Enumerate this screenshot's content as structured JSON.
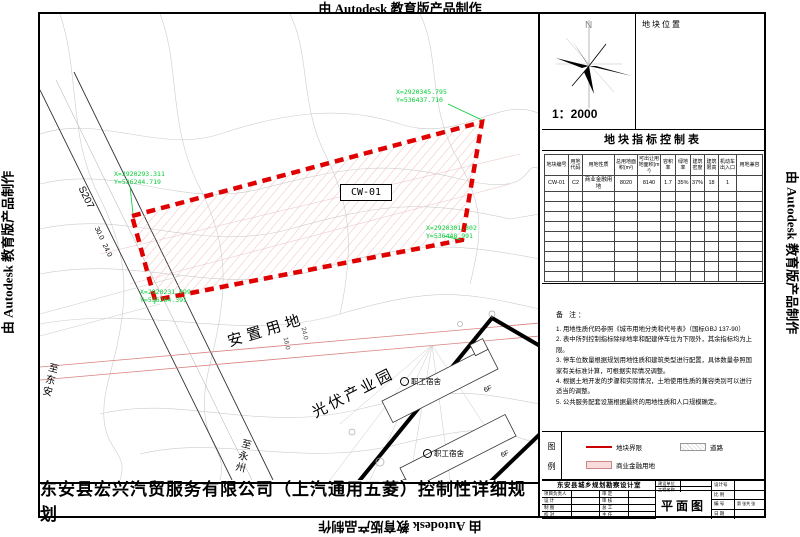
{
  "watermark": {
    "text": "由 Autodesk 教育版产品制作"
  },
  "colors": {
    "boundary_red": "#e00000",
    "coord_green": "#00cc33",
    "parcel_pink": "#f8dcdc"
  },
  "map": {
    "parcel_code": "CW-01",
    "coord_labels": [
      {
        "x": "X=2920345.795",
        "y": "Y=536437.710"
      },
      {
        "x": "X=2920293.311",
        "y": "Y=536244.719"
      },
      {
        "x": "X=2920301.302",
        "y": "Y=536448.991"
      },
      {
        "x": "X=2920231.099",
        "y": "Y=536264.391"
      }
    ],
    "road_label": "S207",
    "dim_30": "30.0",
    "dim_24": "24.0",
    "dim_16": "16.0",
    "dim_24b": "24.0",
    "to_dongan": "至东安",
    "to_yongzhou": "至永州",
    "resettlement_label": "安置用地",
    "pv_park_label": "光伏产业园",
    "dorm_label": "职工宿舍",
    "floors_label": "6F"
  },
  "panel": {
    "north_letter": "N",
    "scale": "1：2000",
    "location_title": "地块位置",
    "table_title": "地块指标控制表",
    "table": {
      "headers": [
        "地块编号",
        "用地代码",
        "用地性质",
        "总用地面积(m²)",
        "可出让用地面积(m²)",
        "容积率",
        "绿地率",
        "建筑密度",
        "建筑限高",
        "机动车出入口",
        "用地兼容"
      ],
      "row": [
        "CW-01",
        "C2",
        "商业金融用地",
        "8020",
        "8140",
        "1.7",
        "35%",
        "37%",
        "18",
        "1",
        ""
      ]
    },
    "notes_title": "备 注：",
    "notes": [
      "1. 用地性质代码参照《城市用地分类和代号表》（国标GBJ 137-90）",
      "2. 表中所列控制指标除绿地率和配建停车位为下限外，其余指标均为上限。",
      "3. 停车位数量根据规划用地性质和建筑类型进行配置，具体数量参照国家有关标准计算，可根据实际情况调整。",
      "4. 根据土地开发的步骤和实际情况，土地使用性质的兼容类别可以进行适当的调整。",
      "5. 公共服务配套设施根据最终的用地性质和人口规模确定。"
    ],
    "legend": {
      "char1": "图",
      "char2": "例",
      "items": [
        "地块界限",
        "道路",
        "商业金融用地"
      ]
    },
    "titleblock": {
      "office": "东安县城乡规划勘察设计室",
      "owner_label": "建设单位",
      "project_label": "工程名称",
      "drawing_title": "平面图",
      "left_rows": [
        [
          "项目负责人",
          "审 定"
        ],
        [
          "设  计",
          "审 核"
        ],
        [
          "制  图",
          "总 工"
        ],
        [
          "校  对",
          "主 任"
        ]
      ],
      "right_rows": [
        "设计号",
        "比 例",
        "编 号",
        "日 期"
      ],
      "sheet_note": "第 张共 张"
    }
  },
  "footer_title": "东安县宏兴汽贸服务有限公司（上汽通用五菱）控制性详细规划"
}
